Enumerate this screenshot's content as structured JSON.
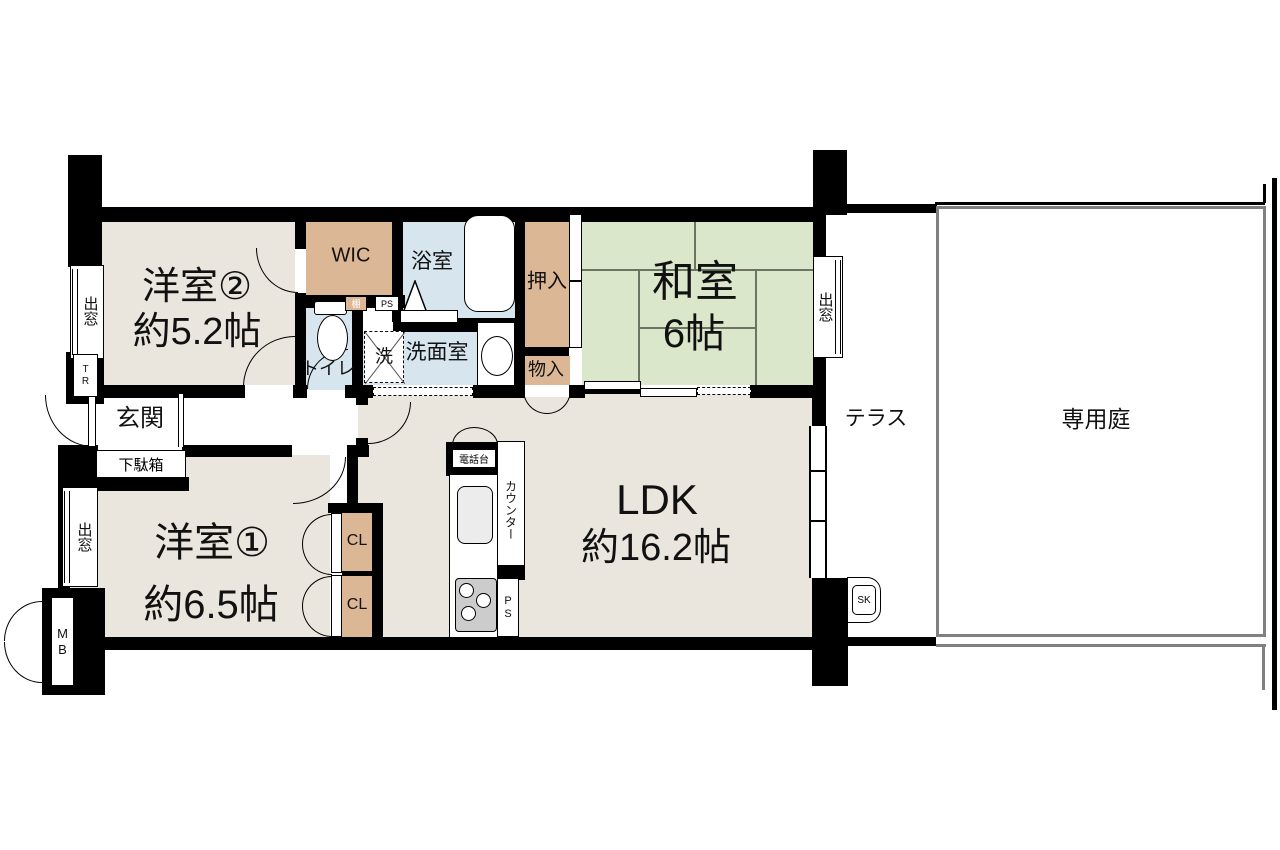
{
  "colors": {
    "wall": "#000000",
    "room_beige": "#eae5dd",
    "closet_tan": "#dcb795",
    "wet_blue": "#d7e5ee",
    "tatami_green": "#dbe7cb",
    "fence_gray": "#808080"
  },
  "rooms": {
    "yoshitsu2": {
      "name": "洋室②",
      "size": "約5.2帖"
    },
    "yoshitsu1": {
      "name": "洋室①",
      "size": "約6.5帖"
    },
    "washitsu": {
      "name": "和室",
      "size": "6帖"
    },
    "ldk": {
      "name": "LDK",
      "size": "約16.2帖"
    },
    "wic": {
      "name": "WIC"
    },
    "bathroom": {
      "name": "浴室"
    },
    "washroom": {
      "name": "洗面室"
    },
    "toilet": {
      "name": "トイレ"
    },
    "oshiire": {
      "name": "押入"
    },
    "monoire": {
      "name": "物入"
    },
    "genkan": {
      "name": "玄関"
    },
    "getabako": {
      "name": "下駄箱"
    },
    "terrace": {
      "name": "テラス"
    },
    "garden": {
      "name": "専用庭"
    },
    "closet1": {
      "name": "CL"
    },
    "closet2": {
      "name": "CL"
    }
  },
  "fixtures": {
    "washer": "洗",
    "phone_stand": "電話台",
    "counter": "カウンター",
    "shelf": "棚",
    "bay_window_1": "出窓",
    "bay_window_2": "出窓",
    "bay_window_3": "出窓",
    "meter_box": "MB",
    "trunk_room": "TR",
    "slop_sink": "SK",
    "pipe_space_1": "PS",
    "pipe_space_2": "PS"
  }
}
